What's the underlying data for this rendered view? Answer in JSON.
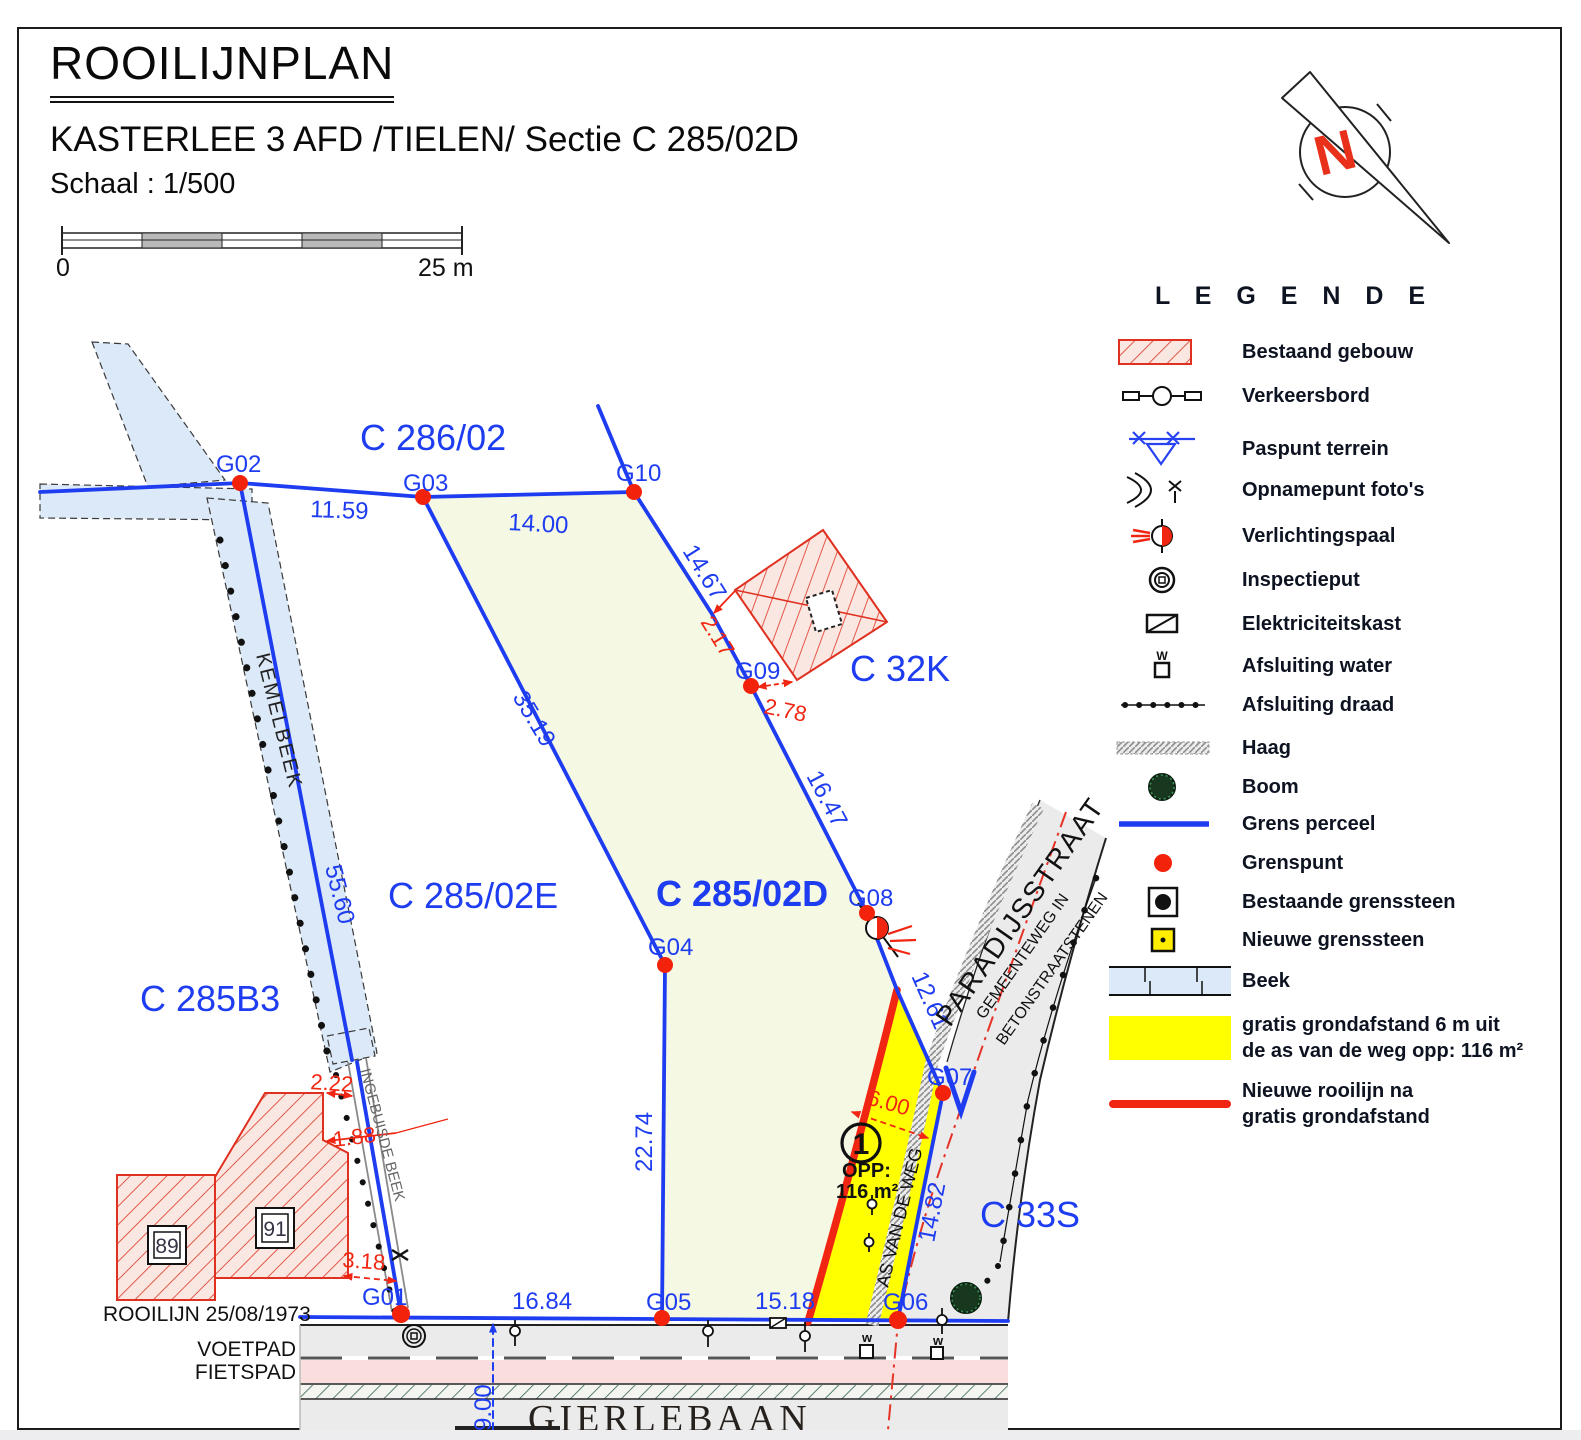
{
  "header": {
    "title": "ROOILIJNPLAN",
    "subtitle": "KASTERLEE 3 AFD /TIELEN/ Sectie C 285/02D",
    "scale": "Schaal : 1/500"
  },
  "scalebar": {
    "zero": "0",
    "max": "25 m"
  },
  "north": {
    "letter": "N"
  },
  "legend": {
    "title": "L E G E N D E",
    "items": [
      {
        "label": "Bestaand gebouw"
      },
      {
        "label": "Verkeersbord"
      },
      {
        "label": "Paspunt terrein"
      },
      {
        "label": "Opnamepunt foto's"
      },
      {
        "label": "Verlichtingspaal"
      },
      {
        "label": "Inspectieput"
      },
      {
        "label": "Elektriciteitskast"
      },
      {
        "label": "Afsluiting water",
        "symbol_letter": "W"
      },
      {
        "label": "Afsluiting draad"
      },
      {
        "label": "Haag"
      },
      {
        "label": "Boom"
      },
      {
        "label": "Grens perceel"
      },
      {
        "label": "Grenspunt"
      },
      {
        "label": "Bestaande grenssteen"
      },
      {
        "label": "Nieuwe grenssteen"
      },
      {
        "label": "Beek"
      },
      {
        "label": "gratis grondafstand 6 m uit",
        "label2": "de as van de weg opp: 116 m²"
      },
      {
        "label": "Nieuwe rooilijn na",
        "label2": "gratis grondafstand"
      }
    ]
  },
  "map": {
    "parcels": {
      "p28602": "C 286/02",
      "p28502e": "C 285/02E",
      "p28502d": "C 285/02D",
      "p285b3": "C 285B3",
      "p32k": "C 32K",
      "p33s": "C 33S"
    },
    "points": {
      "g01": "G01",
      "g02": "G02",
      "g03": "G03",
      "g04": "G04",
      "g05": "G05",
      "g06": "G06",
      "g07": "G07",
      "g08": "G08",
      "g09": "G09",
      "g10": "G10"
    },
    "dims": {
      "d1159": "11.59",
      "d1400": "14.00",
      "d1467": "14.67",
      "d1647": "16.47",
      "d1261": "12.61",
      "d3519": "35.19",
      "d5560": "55.60",
      "d2274": "22.74",
      "d1482": "14.82",
      "d1684": "16.84",
      "d1518": "15.18",
      "d900": "9.00"
    },
    "reddims": {
      "d217": "2.17",
      "d278": "2.78",
      "d600": "6.00",
      "d222": "2.22",
      "d188": "1.88",
      "d318": "3.18"
    },
    "labels": {
      "rooilijn1973": "ROOILIJN 25/08/1973",
      "voetpad": "VOETPAD",
      "fietspad": "FIETSPAD",
      "gierlebaan": "GIERLEBAAN",
      "paradijsstraat": "PARADIJSSTRAAT",
      "gemeenteweg": "GEMEENTEWEG IN",
      "beton": "BETONSTRAATSTENEN",
      "asvandeweg": "AS VAN DE WEG",
      "kemelbeek": "KEMELBEEK",
      "ingebuisde": "INGEBUISDE BEEK",
      "opp": "OPP:",
      "opp_value": "116 m²",
      "zone_number": "1",
      "huis89": "89",
      "huis91": "91",
      "w1": "w",
      "w2": "w"
    }
  },
  "colors": {
    "boundary_blue": "#1E3CF0",
    "accent_red": "#F02613",
    "zone_yellow": "#FFFF00",
    "beek_blue": "#DCE9F8",
    "parcel_green": "#F5F8E3",
    "building_pink": "#FBE7E1",
    "road_gray": "#EBEBEB",
    "path_pink": "#FADDDD"
  }
}
